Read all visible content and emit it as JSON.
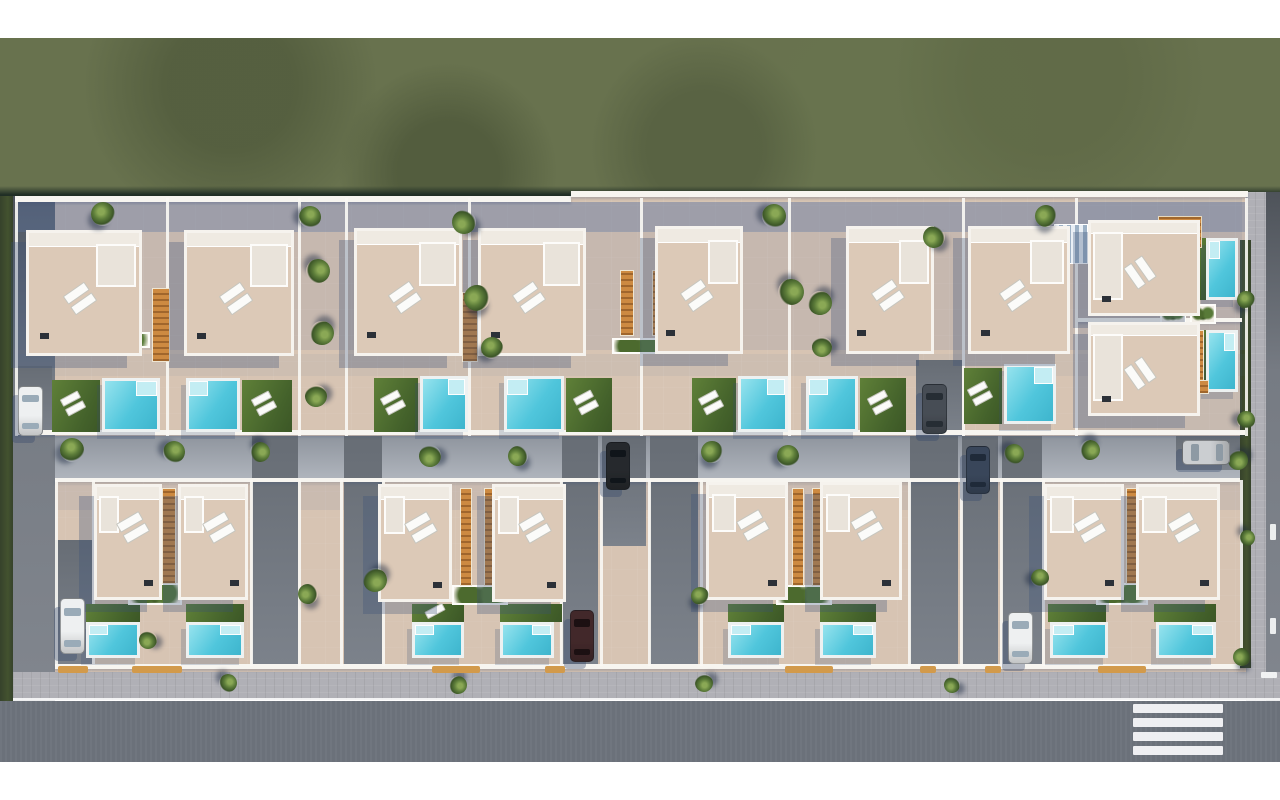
{
  "meta": {
    "title": "aerial-villa-development-render",
    "description": "Aerial 3D architectural rendering of a residential development: two rows of white flat-roofed villas with roof terraces, sun loungers, turquoise swimming pools, lawns, palm trees, parked cars, perimeter roads, sidewalk and a pedestrian crosswalk, surrounded by an olive-green field."
  },
  "palette": {
    "grass": "#68724e",
    "grass_dark": "#223026",
    "hedge": "#3c4a2e",
    "terrace": "#d7c4b3",
    "roof": "#dcc9b7",
    "wall_white": "#f6f3ee",
    "pool_water": "#50c6dc",
    "pool_step": "#c3edf3",
    "lawn": "#4f702f",
    "wood_orange": "#cd8a41",
    "asphalt": "#6d737c",
    "sidewalk": "#b0b0b6",
    "driveway": "#6f757d",
    "shadow_tint": "rgba(88,112,158,0.45)",
    "car_white": "#eef0f1",
    "car_black": "#26292d",
    "car_silver": "#cbced1",
    "car_darkblue": "#39465a",
    "car_darkgray": "#474d55",
    "car_maroon": "#42282a"
  },
  "scene": {
    "bands": {
      "top_white": [
        0,
        0,
        1280,
        38
      ],
      "grass": [
        0,
        38,
        1280,
        158
      ],
      "grass_edge": [
        0,
        186,
        1280,
        12
      ],
      "bottom_white": [
        0,
        762,
        1280,
        38
      ]
    },
    "dev_area": [
      13,
      196,
      1237,
      478
    ],
    "left_hedge": [
      0,
      196,
      13,
      512
    ],
    "left_road": [
      13,
      196,
      42,
      508
    ],
    "right_sidewalk": [
      1246,
      192,
      34,
      512
    ],
    "right_road": [
      1266,
      192,
      14,
      512
    ],
    "bottom_sidewalk": [
      13,
      672,
      1267,
      28
    ],
    "bottom_curb": [
      13,
      698,
      1267,
      3
    ],
    "bottom_road": [
      0,
      701,
      1280,
      61
    ],
    "right_hedge": [
      1240,
      240,
      11,
      428
    ],
    "crosswalk": {
      "x": 1133,
      "w": 90,
      "h": 9,
      "ys": [
        704,
        718,
        732,
        746
      ]
    },
    "lane_dashes": [
      [
        1270,
        524,
        6,
        16
      ],
      [
        1270,
        618,
        6,
        16
      ],
      [
        1261,
        672,
        16,
        6
      ]
    ],
    "shades": [
      [
        15,
        202,
        1230,
        30,
        0.45
      ],
      [
        15,
        232,
        1230,
        118,
        0.13
      ],
      [
        15,
        354,
        1230,
        22,
        0.07
      ],
      [
        55,
        438,
        1185,
        28,
        0.3
      ],
      [
        55,
        484,
        1185,
        26,
        0.1
      ],
      [
        1078,
        198,
        164,
        234,
        0.12
      ]
    ],
    "access_lane": [
      55,
      436,
      1185,
      46
    ],
    "driveways": [
      [
        16,
        366,
        36,
        70
      ],
      [
        916,
        360,
        46,
        76
      ],
      [
        55,
        540,
        37,
        128
      ],
      [
        252,
        436,
        46,
        230
      ],
      [
        344,
        436,
        38,
        230
      ],
      [
        562,
        436,
        36,
        230
      ],
      [
        602,
        436,
        44,
        110
      ],
      [
        650,
        436,
        48,
        230
      ],
      [
        910,
        436,
        48,
        230
      ],
      [
        962,
        436,
        36,
        230
      ],
      [
        1002,
        436,
        40,
        230
      ],
      [
        1176,
        436,
        64,
        34
      ]
    ],
    "hwalls": [
      [
        15,
        196,
        556,
        6
      ],
      [
        571,
        191,
        677,
        6
      ],
      [
        15,
        430,
        1230,
        5
      ],
      [
        55,
        478,
        1185,
        4
      ],
      [
        55,
        664,
        1185,
        5
      ],
      [
        1078,
        318,
        164,
        4
      ]
    ],
    "vwalls_top": [
      [
        15
      ],
      [
        166
      ],
      [
        298
      ],
      [
        345
      ],
      [
        468
      ],
      [
        640
      ],
      [
        788
      ],
      [
        962
      ],
      [
        1075
      ],
      [
        1245
      ]
    ],
    "vwalls_top_y": [
      198,
      238
    ],
    "vwalls_bottom": [
      [
        55
      ],
      [
        92
      ],
      [
        250
      ],
      [
        298
      ],
      [
        340
      ],
      [
        382
      ],
      [
        560
      ],
      [
        600
      ],
      [
        648
      ],
      [
        700
      ],
      [
        908
      ],
      [
        960
      ],
      [
        1000
      ],
      [
        1042
      ],
      [
        1240
      ]
    ],
    "vwalls_bottom_y": [
      480,
      186
    ],
    "houses": [
      [
        26,
        230,
        116,
        126,
        "top"
      ],
      [
        184,
        230,
        110,
        126,
        "top"
      ],
      [
        354,
        228,
        108,
        128,
        "top"
      ],
      [
        478,
        228,
        108,
        128,
        "top"
      ],
      [
        655,
        226,
        88,
        128,
        "top"
      ],
      [
        846,
        226,
        88,
        128,
        "top"
      ],
      [
        968,
        226,
        102,
        128,
        "top"
      ],
      [
        1088,
        220,
        112,
        96,
        "side"
      ],
      [
        1088,
        322,
        112,
        94,
        "side"
      ],
      [
        94,
        484,
        68,
        116,
        "bottom"
      ],
      [
        178,
        484,
        70,
        116,
        "bottom"
      ],
      [
        378,
        484,
        74,
        118,
        "bottom"
      ],
      [
        492,
        484,
        74,
        118,
        "bottom"
      ],
      [
        706,
        482,
        82,
        118,
        "bottom"
      ],
      [
        820,
        482,
        82,
        118,
        "bottom"
      ],
      [
        1044,
        484,
        80,
        116,
        "bottom"
      ],
      [
        1136,
        484,
        84,
        116,
        "bottom"
      ]
    ],
    "stairs": [
      [
        152,
        288,
        18,
        74
      ],
      [
        462,
        292,
        16,
        70
      ],
      [
        620,
        270,
        14,
        66
      ],
      [
        652,
        270,
        14,
        66
      ],
      [
        1196,
        330,
        8,
        56
      ],
      [
        162,
        488,
        14,
        96
      ],
      [
        460,
        488,
        12,
        98
      ],
      [
        484,
        488,
        12,
        98
      ],
      [
        792,
        488,
        12,
        98
      ],
      [
        812,
        488,
        12,
        98
      ],
      [
        1126,
        488,
        12,
        96
      ],
      [
        1183,
        380,
        26,
        14
      ]
    ],
    "pergola": [
      1158,
      216,
      44,
      32
    ],
    "blue_stairs": [
      1054,
      224,
      34,
      40
    ],
    "planters": [
      [
        94,
        332,
        56,
        16
      ],
      [
        430,
        334,
        54,
        16
      ],
      [
        612,
        338,
        54,
        16
      ],
      [
        1160,
        304,
        26,
        20
      ],
      [
        1190,
        304,
        26,
        20
      ],
      [
        128,
        583,
        54,
        22
      ],
      [
        452,
        585,
        56,
        20
      ],
      [
        776,
        585,
        56,
        20
      ],
      [
        1096,
        583,
        52,
        22
      ]
    ],
    "pools": [
      [
        102,
        378,
        58,
        54
      ],
      [
        186,
        378,
        54,
        54
      ],
      [
        420,
        376,
        48,
        56
      ],
      [
        504,
        376,
        60,
        56
      ],
      [
        738,
        376,
        50,
        56
      ],
      [
        806,
        376,
        52,
        56
      ],
      [
        1004,
        364,
        52,
        60
      ],
      [
        1206,
        238,
        32,
        62
      ],
      [
        1206,
        330,
        32,
        62
      ],
      [
        86,
        622,
        54,
        36
      ],
      [
        186,
        622,
        58,
        36
      ],
      [
        412,
        622,
        52,
        36
      ],
      [
        500,
        622,
        54,
        36
      ],
      [
        728,
        622,
        56,
        36
      ],
      [
        820,
        622,
        56,
        36
      ],
      [
        1050,
        622,
        58,
        36
      ],
      [
        1156,
        622,
        60,
        36
      ]
    ],
    "lawns": [
      [
        52,
        380,
        48,
        52,
        1
      ],
      [
        242,
        380,
        50,
        52,
        1
      ],
      [
        374,
        378,
        44,
        54,
        1
      ],
      [
        566,
        378,
        46,
        54,
        1
      ],
      [
        692,
        378,
        44,
        54,
        1
      ],
      [
        860,
        378,
        46,
        54,
        1
      ],
      [
        964,
        368,
        38,
        56,
        1
      ],
      [
        1198,
        238,
        8,
        62,
        0
      ],
      [
        1198,
        330,
        8,
        62,
        0
      ],
      [
        86,
        604,
        54,
        18,
        0
      ],
      [
        186,
        604,
        58,
        18,
        0
      ],
      [
        412,
        604,
        52,
        18,
        2
      ],
      [
        500,
        604,
        62,
        18,
        0
      ],
      [
        728,
        604,
        56,
        18,
        0
      ],
      [
        820,
        604,
        56,
        18,
        0
      ],
      [
        1048,
        604,
        58,
        18,
        0
      ],
      [
        1154,
        604,
        62,
        18,
        0
      ]
    ],
    "curb_marks": [
      [
        58,
        666,
        30,
        7
      ],
      [
        132,
        666,
        50,
        7
      ],
      [
        432,
        666,
        48,
        7
      ],
      [
        545,
        666,
        20,
        7
      ],
      [
        785,
        666,
        48,
        7
      ],
      [
        920,
        666,
        16,
        7
      ],
      [
        985,
        666,
        16,
        7
      ],
      [
        1098,
        666,
        48,
        7
      ]
    ],
    "trees": [
      [
        103,
        214,
        12
      ],
      [
        310,
        217,
        11
      ],
      [
        318,
        271,
        12
      ],
      [
        322,
        333,
        12
      ],
      [
        316,
        396,
        11
      ],
      [
        464,
        222,
        12
      ],
      [
        477,
        298,
        13
      ],
      [
        492,
        348,
        11
      ],
      [
        774,
        216,
        12
      ],
      [
        791,
        292,
        13
      ],
      [
        820,
        303,
        12
      ],
      [
        822,
        347,
        10
      ],
      [
        934,
        237,
        11
      ],
      [
        1046,
        216,
        11
      ],
      [
        72,
        450,
        12
      ],
      [
        174,
        452,
        11
      ],
      [
        260,
        452,
        10
      ],
      [
        375,
        580,
        12
      ],
      [
        430,
        456,
        11
      ],
      [
        518,
        456,
        10
      ],
      [
        712,
        452,
        11
      ],
      [
        788,
        456,
        11
      ],
      [
        1014,
        454,
        10
      ],
      [
        1090,
        450,
        10
      ],
      [
        1238,
        460,
        10
      ],
      [
        148,
        640,
        9
      ],
      [
        308,
        594,
        10
      ],
      [
        700,
        596,
        9
      ],
      [
        1040,
        578,
        9
      ],
      [
        228,
        683,
        9
      ],
      [
        458,
        685,
        9
      ],
      [
        704,
        683,
        9
      ],
      [
        952,
        685,
        8
      ],
      [
        1242,
        657,
        9
      ],
      [
        1246,
        300,
        9
      ],
      [
        1246,
        420,
        9
      ],
      [
        1247,
        538,
        8
      ]
    ],
    "cars": [
      [
        18,
        386,
        25,
        50,
        "white",
        "v"
      ],
      [
        922,
        384,
        25,
        50,
        "darkgray",
        "v"
      ],
      [
        60,
        598,
        25,
        56,
        "white",
        "v"
      ],
      [
        606,
        442,
        24,
        48,
        "black",
        "v"
      ],
      [
        570,
        610,
        24,
        52,
        "maroon",
        "v"
      ],
      [
        966,
        446,
        24,
        48,
        "darkblue",
        "v"
      ],
      [
        1008,
        612,
        25,
        52,
        "white",
        "v"
      ],
      [
        1182,
        440,
        48,
        25,
        "silver",
        "h"
      ]
    ]
  }
}
